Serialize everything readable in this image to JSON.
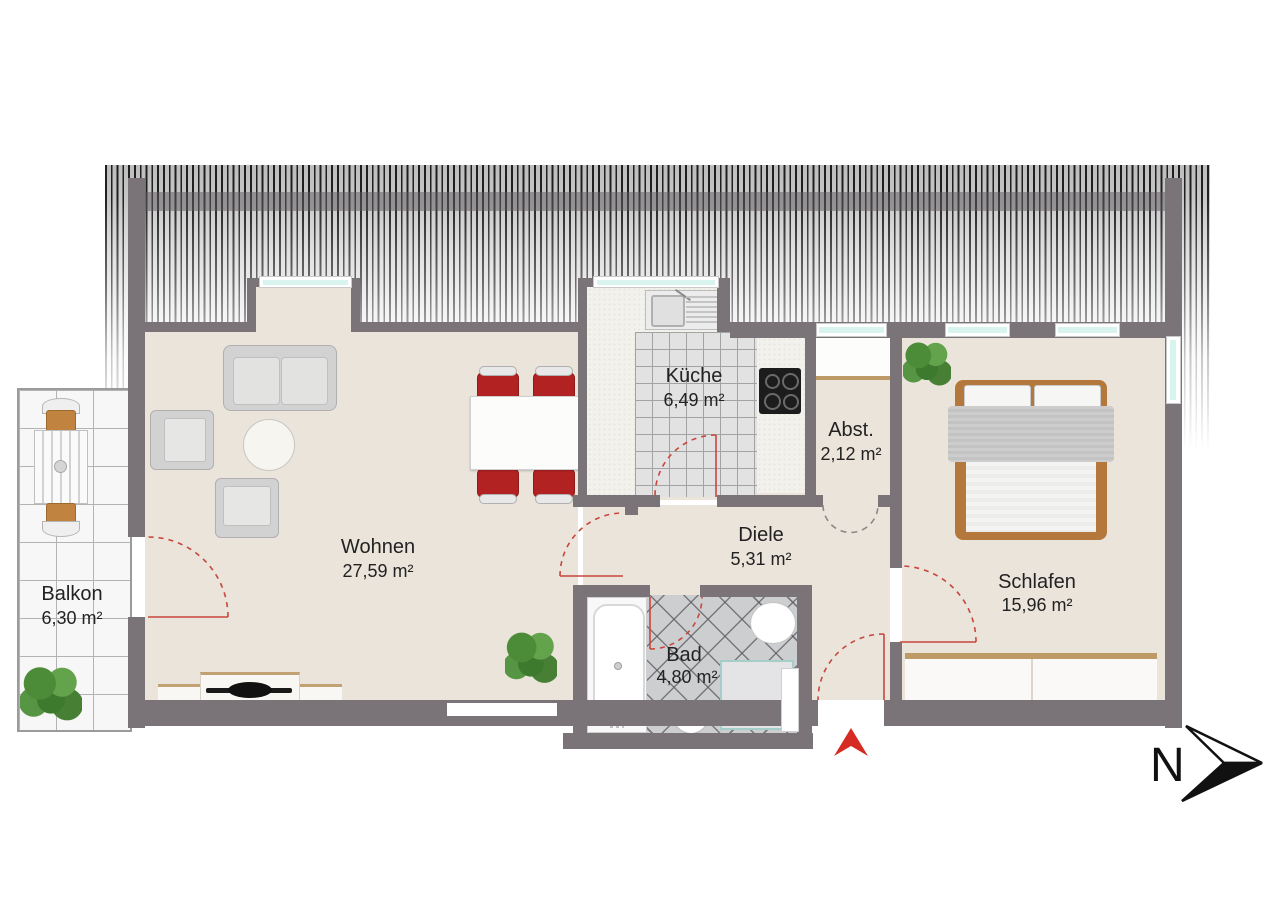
{
  "plan": {
    "compass": {
      "label": "N"
    },
    "rooms": [
      {
        "id": "balkon",
        "label": "Balkon",
        "area": "6,30 m²"
      },
      {
        "id": "wohnen",
        "label": "Wohnen",
        "area": "27,59 m²"
      },
      {
        "id": "kueche",
        "label": "Küche",
        "area": "6,49 m²"
      },
      {
        "id": "abst",
        "label": "Abst.",
        "area": "2,12 m²"
      },
      {
        "id": "diele",
        "label": "Diele",
        "area": "5,31 m²"
      },
      {
        "id": "bad",
        "label": "Bad",
        "area": "4,80 m²"
      },
      {
        "id": "schlafen",
        "label": "Schlafen",
        "area": "15,96 m²"
      }
    ],
    "colors": {
      "wall": "#7a7478",
      "floor": "#eae4da",
      "roof_stripe": "#1f1f1f",
      "balcony_tile": "#f7f7f7",
      "kitchen_tile": "#e2e2e2",
      "bath_tile": "#cdced0",
      "counter": "#f2f1ec",
      "wood": "#b5783c",
      "wood_trim": "#bd9a66",
      "door_swing": "#c8473d",
      "entrance_marker": "#d62b22",
      "window_glass": "#d9f3ef",
      "window_frame": "#ffffff",
      "sofa_gray": "#d2d2d2",
      "chair_red": "#b32222",
      "compass_ink": "#111111"
    }
  }
}
